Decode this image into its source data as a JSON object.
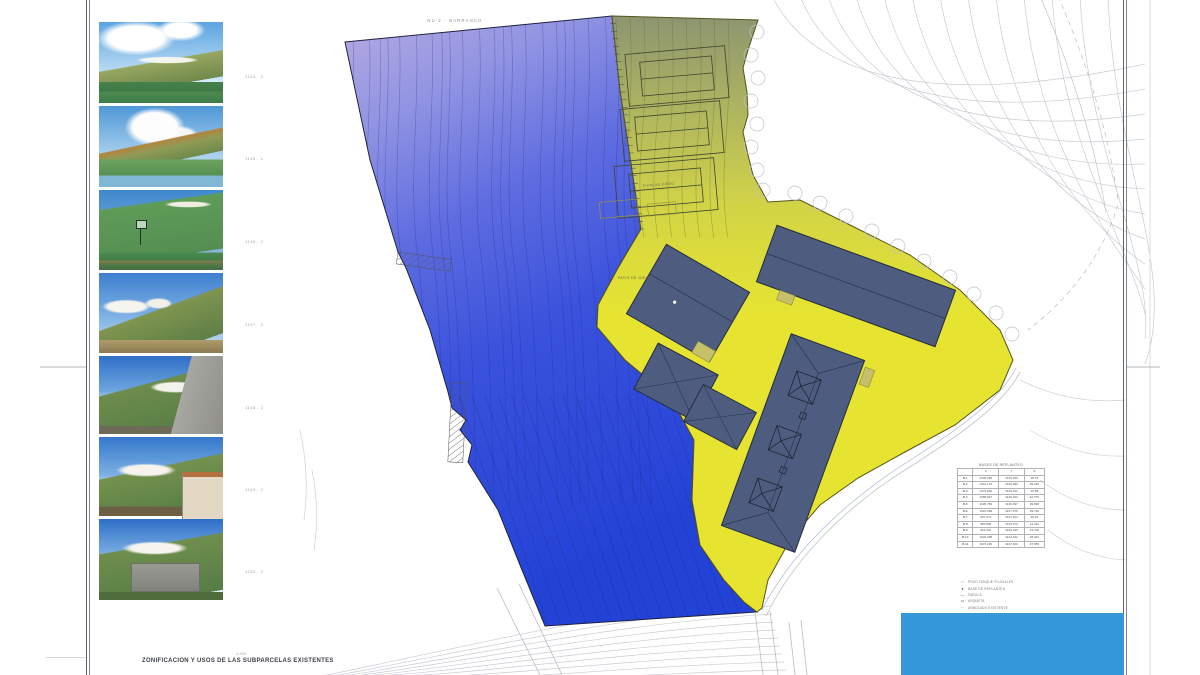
{
  "sheet": {
    "top_note": "NU-2  -  BARRANCO",
    "bottom_title": "ZONIFICACION Y USOS DE LAS SUBPARCELAS EXISTENTES",
    "scale_note": "1:200"
  },
  "photos": [
    {
      "label": "1144 - 2"
    },
    {
      "label": "1145 - 2"
    },
    {
      "label": "1146 - 2"
    },
    {
      "label": "1147 - 2"
    },
    {
      "label": "1148 - 2"
    },
    {
      "label": "1149 - 2"
    },
    {
      "label": "1150 - 2"
    }
  ],
  "plan": {
    "labels": {
      "patio": "PATIO DE JUEGO",
      "pista": "PISTA DE JUEGO"
    }
  },
  "survey_table": {
    "title": "BASES DE REPLANTEO",
    "columns": [
      "",
      "X",
      "Y",
      "Z"
    ],
    "rows": [
      [
        "B-1",
        "1030.299",
        "3136.030",
        "38.79"
      ],
      [
        "B-2",
        "1041.176",
        "3135.080",
        "39.235"
      ],
      [
        "B-3",
        "1079.802",
        "3135.432",
        "40.88"
      ],
      [
        "B-4",
        "1068.827",
        "3136.493",
        "40.575"
      ],
      [
        "B-5",
        "1035.783",
        "3136.097",
        "39.838"
      ],
      [
        "B-6",
        "1010.288",
        "3137.075",
        "39.726"
      ],
      [
        "B-7",
        "997.074",
        "3137.194",
        "39.23"
      ],
      [
        "B-8",
        "980.838",
        "3139.075",
        "41.324"
      ],
      [
        "B-9",
        "962.301",
        "3140.335",
        "43.708"
      ],
      [
        "B-10",
        "1032.098",
        "3143.332",
        "48.024"
      ],
      [
        "B-11",
        "1047.239",
        "3137.320",
        "37.585"
      ]
    ]
  },
  "legend": {
    "items": [
      {
        "symbol": "circle",
        "label": "POZO TANQUE PLUVIALES"
      },
      {
        "symbol": "dot",
        "label": "BASE DE REPLANTEO"
      },
      {
        "symbol": "dash",
        "label": "FAROLA"
      },
      {
        "symbol": "rect",
        "label": "ARQUETA"
      },
      {
        "symbol": "dashes",
        "label": "ARBOLADO EXISTENTE"
      }
    ]
  },
  "colors": {
    "zone_lavender": "#b6abe2",
    "zone_blue": "#2342d6",
    "zone_olive": "#8d9572",
    "zone_yellow": "#e6e431",
    "building": "#4e5d7f",
    "cover": "#3498db"
  }
}
